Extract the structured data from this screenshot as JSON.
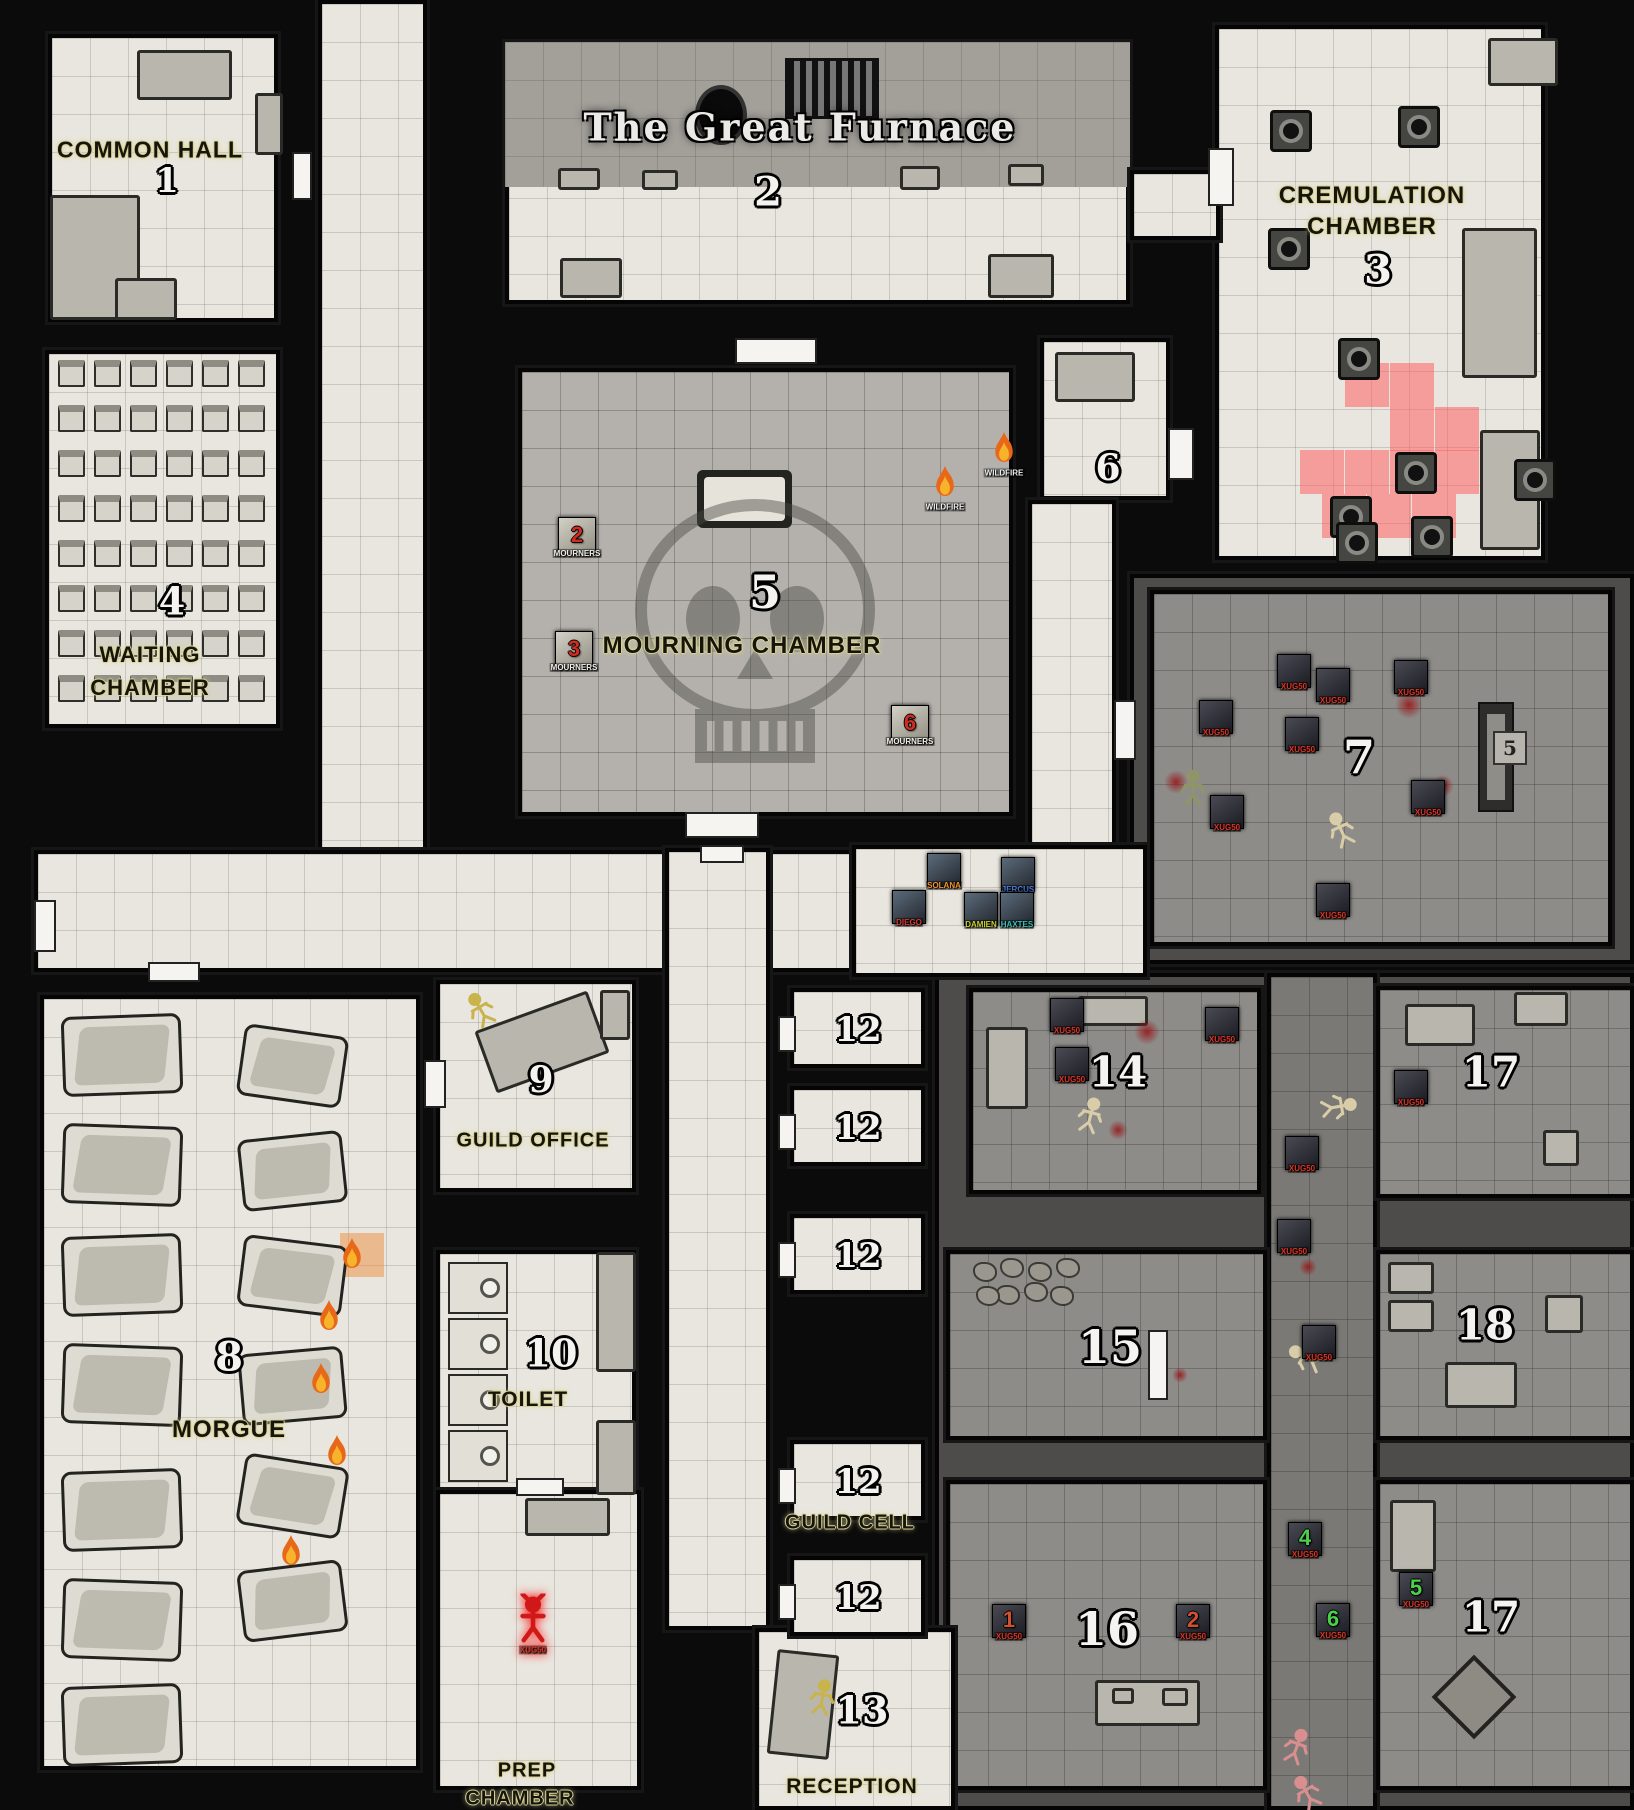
{
  "palette": {
    "wall": "#0b0b0b",
    "paper": "#e9e6df",
    "paper_dim": "#b4b1ac",
    "fog": "#4e4c4a",
    "fog_room": "#8e8c89",
    "fog_corridor": "#7b7975",
    "label_glow": "#d9d397",
    "red_highlight": "rgba(255,96,96,0.55)",
    "mourner_number": "#d22c20",
    "monster_label": "#e03424",
    "green_number": "#4ad04a",
    "rust_number": "#d05030",
    "flame_orange": "#e8681a",
    "flame_yellow": "#f7b32b",
    "blood": "#961414",
    "demon_red": "#d01818"
  },
  "title": {
    "text": "The Great Furnace",
    "x": 800,
    "y": 127,
    "size": 38
  },
  "rooms": [
    [
      "room-common-hall",
      48,
      34,
      230,
      288,
      "paper",
      1
    ],
    [
      "room-great-furnace",
      505,
      42,
      625,
      262,
      "paper",
      1
    ],
    [
      "furnace-strip",
      505,
      42,
      625,
      145,
      "strip",
      1
    ],
    [
      "room-cremulation-chamber",
      1215,
      25,
      330,
      535,
      "paper",
      1
    ],
    [
      "room-waiting-chamber",
      45,
      350,
      235,
      378,
      "paper",
      1
    ],
    [
      "corridor-left",
      318,
      0,
      109,
      852,
      "paper",
      1
    ],
    [
      "corridor-link-2-3",
      1130,
      170,
      90,
      70,
      "paper",
      1
    ],
    [
      "room-mourning-chamber",
      518,
      368,
      495,
      448,
      "paperdim",
      2
    ],
    [
      "room-6",
      1040,
      338,
      130,
      162,
      "paper",
      1
    ],
    [
      "corridor-east",
      1028,
      500,
      88,
      348,
      "paper",
      1
    ],
    [
      "corridor-main",
      34,
      850,
      1112,
      122,
      "paper",
      1
    ],
    [
      "fog-room7-region",
      1130,
      574,
      504,
      390,
      "fog",
      0
    ],
    [
      "room-7",
      1150,
      590,
      462,
      356,
      "fogroom",
      2
    ],
    [
      "fog-south-region",
      935,
      973,
      699,
      837,
      "fog",
      0
    ],
    [
      "corridor-party",
      852,
      845,
      295,
      132,
      "paper",
      1
    ],
    [
      "corridor-center",
      665,
      848,
      105,
      782,
      "paper",
      1
    ],
    [
      "corridor-fog-middle",
      1267,
      973,
      110,
      837,
      "fogcorr",
      2
    ],
    [
      "room-14",
      969,
      988,
      292,
      206,
      "fogroom",
      2
    ],
    [
      "room-17-top",
      1376,
      986,
      258,
      212,
      "fogroom",
      2
    ],
    [
      "room-15",
      946,
      1250,
      321,
      190,
      "fogroom",
      2
    ],
    [
      "room-18",
      1376,
      1250,
      258,
      190,
      "fogroom",
      2
    ],
    [
      "room-16",
      946,
      1480,
      321,
      310,
      "fogroom",
      2
    ],
    [
      "room-17-bottom",
      1376,
      1480,
      258,
      310,
      "fogroom",
      2
    ],
    [
      "room-morgue",
      40,
      995,
      380,
      775,
      "paper",
      1
    ],
    [
      "room-guild-office",
      436,
      980,
      200,
      212,
      "paper",
      1
    ],
    [
      "room-toilet",
      436,
      1250,
      200,
      264,
      "paper",
      1
    ],
    [
      "room-prep-chamber",
      436,
      1490,
      205,
      300,
      "paper",
      1
    ],
    [
      "room-reception",
      755,
      1628,
      200,
      182,
      "paper",
      1
    ],
    [
      "guild-cell-1",
      790,
      988,
      135,
      80,
      "paper",
      1
    ],
    [
      "guild-cell-2",
      790,
      1086,
      135,
      80,
      "paper",
      1
    ],
    [
      "guild-cell-3",
      790,
      1214,
      135,
      80,
      "paper",
      1
    ],
    [
      "guild-cell-4",
      790,
      1440,
      135,
      80,
      "paper",
      1
    ],
    [
      "guild-cell-5",
      790,
      1556,
      135,
      80,
      "paper",
      1
    ]
  ],
  "labels": [
    [
      "COMMON HALL",
      150,
      150,
      23
    ],
    [
      "CREMULATION",
      1372,
      196,
      24
    ],
    [
      "CHAMBER",
      1372,
      227,
      24
    ],
    [
      "WAITING",
      150,
      655,
      22
    ],
    [
      "CHAMBER",
      150,
      688,
      22
    ],
    [
      "MOURNING CHAMBER",
      742,
      646,
      24
    ],
    [
      "MORGUE",
      229,
      1430,
      24
    ],
    [
      "GUILD OFFICE",
      533,
      1141,
      20
    ],
    [
      "TOILET",
      528,
      1400,
      21
    ],
    [
      "GUILD CELL",
      850,
      1523,
      20
    ],
    [
      "RECEPTION",
      852,
      1787,
      21
    ],
    [
      "PREP",
      527,
      1771,
      20
    ],
    [
      "CHAMBER",
      520,
      1799,
      20
    ]
  ],
  "numbers": [
    [
      "1",
      167,
      181,
      34
    ],
    [
      "2",
      768,
      192,
      40
    ],
    [
      "3",
      1378,
      270,
      40
    ],
    [
      "4",
      172,
      601,
      38
    ],
    [
      "5",
      765,
      592,
      46
    ],
    [
      "6",
      1108,
      468,
      36
    ],
    [
      "7",
      1359,
      757,
      46
    ],
    [
      "8",
      229,
      1357,
      40
    ],
    [
      "9",
      541,
      1080,
      36
    ],
    [
      "10",
      551,
      1353,
      38
    ],
    [
      "12",
      858,
      1030,
      34
    ],
    [
      "12",
      858,
      1128,
      34
    ],
    [
      "12",
      858,
      1256,
      34
    ],
    [
      "12",
      858,
      1482,
      34
    ],
    [
      "12",
      858,
      1598,
      34
    ],
    [
      "13",
      862,
      1710,
      38
    ],
    [
      "14",
      1118,
      1072,
      42
    ],
    [
      "15",
      1110,
      1347,
      46
    ],
    [
      "16",
      1107,
      1629,
      46
    ],
    [
      "17",
      1491,
      1072,
      42
    ],
    [
      "17",
      1491,
      1617,
      42
    ],
    [
      "18",
      1485,
      1325,
      42
    ]
  ],
  "tokens": {
    "party": [
      {
        "label": "SOLANA",
        "color": "#f0932b",
        "x": 944,
        "y": 870
      },
      {
        "label": "JERCUS",
        "color": "#4f7fd9",
        "x": 1018,
        "y": 874
      },
      {
        "label": "DIEGO",
        "color": "#d43a2f",
        "x": 909,
        "y": 907
      },
      {
        "label": "DAMIEN",
        "color": "#c9d22e",
        "x": 981,
        "y": 909
      },
      {
        "label": "HAXTES",
        "color": "#35c2b8",
        "x": 1017,
        "y": 909
      }
    ],
    "mourner_label": "MOURNERS",
    "mourners": [
      {
        "number": "2",
        "x": 577,
        "y": 536
      },
      {
        "number": "3",
        "x": 574,
        "y": 650
      },
      {
        "number": "6",
        "x": 910,
        "y": 724
      }
    ],
    "monster_label": "XUG50",
    "monsters": [
      {
        "x": 1216,
        "y": 717
      },
      {
        "x": 1294,
        "y": 671
      },
      {
        "x": 1333,
        "y": 685
      },
      {
        "x": 1411,
        "y": 677
      },
      {
        "x": 1302,
        "y": 734
      },
      {
        "x": 1227,
        "y": 812
      },
      {
        "x": 1428,
        "y": 797
      },
      {
        "x": 1333,
        "y": 900
      },
      {
        "x": 1067,
        "y": 1015
      },
      {
        "x": 1222,
        "y": 1024
      },
      {
        "x": 1072,
        "y": 1064
      },
      {
        "x": 1411,
        "y": 1087
      },
      {
        "x": 1302,
        "y": 1153
      },
      {
        "x": 1294,
        "y": 1236
      },
      {
        "x": 1319,
        "y": 1342
      },
      {
        "x": 1305,
        "y": 1539,
        "number": "4",
        "numColor": "#4ad04a"
      },
      {
        "x": 1416,
        "y": 1589,
        "number": "5",
        "numColor": "#4ad04a"
      },
      {
        "x": 1333,
        "y": 1620,
        "number": "6",
        "numColor": "#4ad04a"
      },
      {
        "x": 1009,
        "y": 1621,
        "number": "1",
        "numColor": "#d05030"
      },
      {
        "x": 1193,
        "y": 1621,
        "number": "2",
        "numColor": "#d05030"
      }
    ],
    "flame_label": "WILDFIRE",
    "flames": [
      {
        "x": 945,
        "y": 486,
        "labeled": true
      },
      {
        "x": 1004,
        "y": 452,
        "labeled": true
      },
      {
        "x": 352,
        "y": 1258
      },
      {
        "x": 329,
        "y": 1320
      },
      {
        "x": 321,
        "y": 1383
      },
      {
        "x": 337,
        "y": 1455
      },
      {
        "x": 291,
        "y": 1555
      }
    ],
    "marker": {
      "text": "5",
      "x": 1510,
      "y": 748
    },
    "demon": {
      "x": 533,
      "y": 1622,
      "label": "XUG50"
    }
  },
  "doors": [
    [
      292,
      152,
      20,
      48
    ],
    [
      735,
      338,
      82,
      26
    ],
    [
      685,
      812,
      74,
      26
    ],
    [
      1168,
      428,
      26,
      52
    ],
    [
      1208,
      148,
      26,
      58
    ],
    [
      516,
      1478,
      48,
      18
    ],
    [
      1148,
      1330,
      20,
      70
    ],
    [
      424,
      1060,
      22,
      48
    ],
    [
      148,
      962,
      52,
      20
    ],
    [
      1114,
      700,
      22,
      60
    ],
    [
      700,
      845,
      44,
      18
    ],
    [
      34,
      900,
      22,
      52
    ],
    [
      778,
      1016,
      18,
      36
    ],
    [
      778,
      1114,
      18,
      36
    ],
    [
      778,
      1242,
      18,
      36
    ],
    [
      778,
      1468,
      18,
      36
    ],
    [
      778,
      1584,
      18,
      36
    ]
  ],
  "dark_door": [
    1478,
    702,
    36,
    110
  ],
  "furniture_boxes": [
    [
      137,
      50,
      95,
      50,
      0
    ],
    [
      255,
      93,
      28,
      62,
      0
    ],
    [
      50,
      195,
      90,
      125,
      0
    ],
    [
      115,
      278,
      62,
      42,
      0
    ],
    [
      558,
      168,
      42,
      22,
      0
    ],
    [
      642,
      170,
      36,
      20,
      0
    ],
    [
      900,
      166,
      40,
      24,
      0
    ],
    [
      1008,
      164,
      36,
      22,
      0
    ],
    [
      560,
      258,
      62,
      40,
      0
    ],
    [
      988,
      254,
      66,
      44,
      0
    ],
    [
      1462,
      228,
      75,
      150,
      0
    ],
    [
      1480,
      430,
      60,
      120,
      0
    ],
    [
      1488,
      38,
      70,
      48,
      0
    ],
    [
      1055,
      352,
      80,
      50,
      0
    ],
    [
      482,
      1009,
      120,
      66,
      -20
    ],
    [
      600,
      990,
      30,
      50,
      0
    ],
    [
      596,
      1252,
      40,
      120,
      0
    ],
    [
      596,
      1420,
      40,
      75,
      0
    ],
    [
      525,
      1498,
      85,
      38,
      0
    ],
    [
      772,
      1652,
      62,
      105,
      6
    ],
    [
      986,
      1027,
      42,
      82,
      0
    ],
    [
      1078,
      996,
      70,
      30,
      0
    ],
    [
      1405,
      1004,
      70,
      42,
      0
    ],
    [
      1514,
      992,
      54,
      34,
      0
    ],
    [
      1543,
      1130,
      36,
      36,
      0
    ],
    [
      1388,
      1262,
      46,
      32,
      0
    ],
    [
      1388,
      1300,
      46,
      32,
      0
    ],
    [
      1445,
      1362,
      72,
      46,
      0
    ],
    [
      1545,
      1295,
      38,
      38,
      0
    ],
    [
      1095,
      1680,
      105,
      46,
      0
    ],
    [
      1112,
      1688,
      22,
      16,
      0
    ],
    [
      1162,
      1688,
      26,
      18,
      0
    ],
    [
      1390,
      1500,
      46,
      72,
      0
    ]
  ],
  "furnaces": [
    [
      1270,
      110
    ],
    [
      1398,
      106
    ],
    [
      1268,
      228
    ],
    [
      1338,
      338
    ],
    [
      1395,
      452
    ],
    [
      1330,
      496
    ],
    [
      1514,
      459
    ],
    [
      1336,
      522
    ],
    [
      1411,
      516
    ]
  ],
  "red_cells": [
    [
      1345,
      363
    ],
    [
      1390,
      363
    ],
    [
      1390,
      407
    ],
    [
      1435,
      407
    ],
    [
      1300,
      450
    ],
    [
      1345,
      450
    ],
    [
      1390,
      450
    ],
    [
      1435,
      450
    ],
    [
      1322,
      494
    ],
    [
      1367,
      494
    ],
    [
      1412,
      494
    ]
  ],
  "orange_cell": [
    340,
    1233
  ],
  "grate": [
    785,
    58,
    88,
    55
  ],
  "oval": [
    695,
    85,
    52,
    60
  ],
  "coffin": [
    697,
    470,
    95,
    58
  ],
  "diamond": [
    1474,
    1697,
    60
  ],
  "chairs": {
    "x": 58,
    "y": 360,
    "cols": 6,
    "rows": 8,
    "dx": 36,
    "dy": 45,
    "size": 27
  },
  "slabs_col1": {
    "x": 62,
    "w": 120,
    "h": 80,
    "ys": [
      1015,
      1125,
      1235,
      1345,
      1470,
      1580,
      1685
    ]
  },
  "slabs_col2": {
    "x": 240,
    "w": 105,
    "h": 72,
    "items": [
      [
        1030,
        8
      ],
      [
        1135,
        -6
      ],
      [
        1240,
        7
      ],
      [
        1350,
        -5
      ],
      [
        1460,
        9
      ],
      [
        1565,
        -7
      ]
    ]
  },
  "stalls": {
    "x": 448,
    "w": 60,
    "h": 52,
    "ys": [
      1262,
      1318,
      1374,
      1430
    ]
  },
  "rubble": [
    [
      985,
      1272
    ],
    [
      1012,
      1268
    ],
    [
      1040,
      1272
    ],
    [
      1068,
      1268
    ],
    [
      1008,
      1295
    ],
    [
      1036,
      1292
    ],
    [
      1062,
      1296
    ],
    [
      988,
      1296
    ]
  ],
  "blood": [
    [
      1409,
      705,
      28
    ],
    [
      1443,
      786,
      22
    ],
    [
      1176,
      782,
      24
    ],
    [
      1147,
      1032,
      26
    ],
    [
      1118,
      1130,
      20
    ],
    [
      1308,
      1267,
      18
    ],
    [
      1180,
      1375,
      16
    ]
  ],
  "skeletons": [
    [
      1342,
      832,
      -25
    ],
    [
      1090,
      1118,
      15
    ],
    [
      1336,
      1107,
      80
    ],
    [
      1308,
      1359,
      -60
    ]
  ],
  "pink_skeletons": [
    [
      1296,
      1749,
      20
    ],
    [
      1308,
      1795,
      -30
    ]
  ],
  "zombie": [
    1193,
    791
  ],
  "corpses": [
    [
      822,
      1700,
      10
    ],
    [
      482,
      1012,
      -30
    ]
  ],
  "skull": {
    "x": 755,
    "y": 640,
    "w": 300,
    "h": 330
  }
}
